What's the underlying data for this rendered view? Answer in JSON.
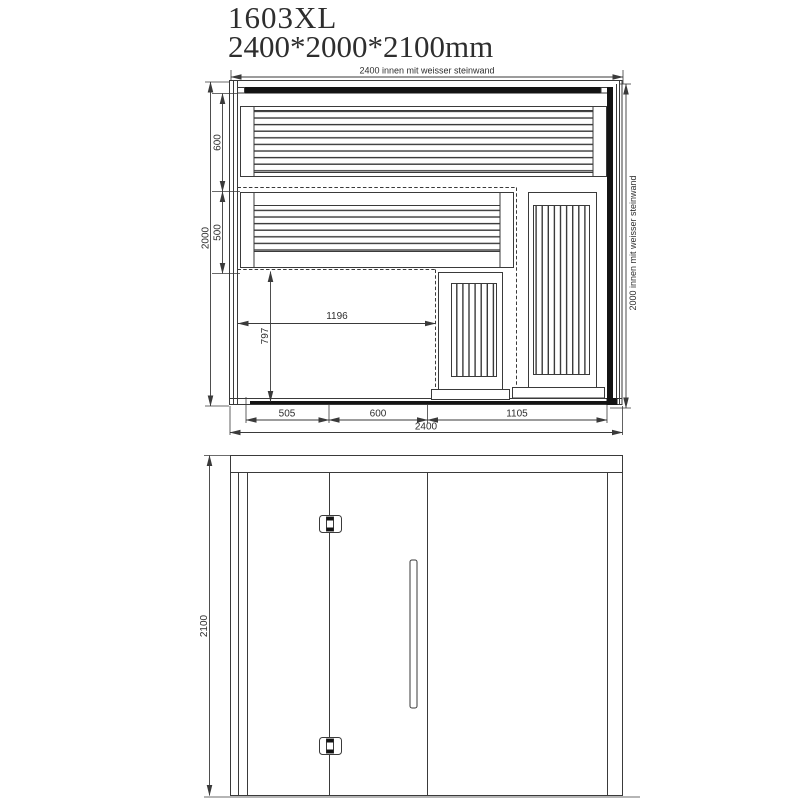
{
  "title": {
    "model": "1603XL",
    "dimensions": "2400*2000*2100mm"
  },
  "plan_view": {
    "dim_width_inner": "2400 innen mit weisser steinwand",
    "dim_depth_inner": "2000 innen mit weisser steinwand",
    "dim_depth_overall": "2000",
    "dim_upper_bench_depth": "600",
    "dim_lower_bench_depth": "500",
    "dim_floor_width": "1196",
    "dim_floor_depth": "797",
    "dim_front_left_panel": "505",
    "dim_front_door": "600",
    "dim_front_right_panel": "1105",
    "dim_width_overall": "2400"
  },
  "front_view": {
    "dim_height_overall": "2100"
  },
  "colors": {
    "line": "#3a3a3a",
    "dark": "#141414",
    "text": "#2e2e2e",
    "bg": "#ffffff"
  }
}
